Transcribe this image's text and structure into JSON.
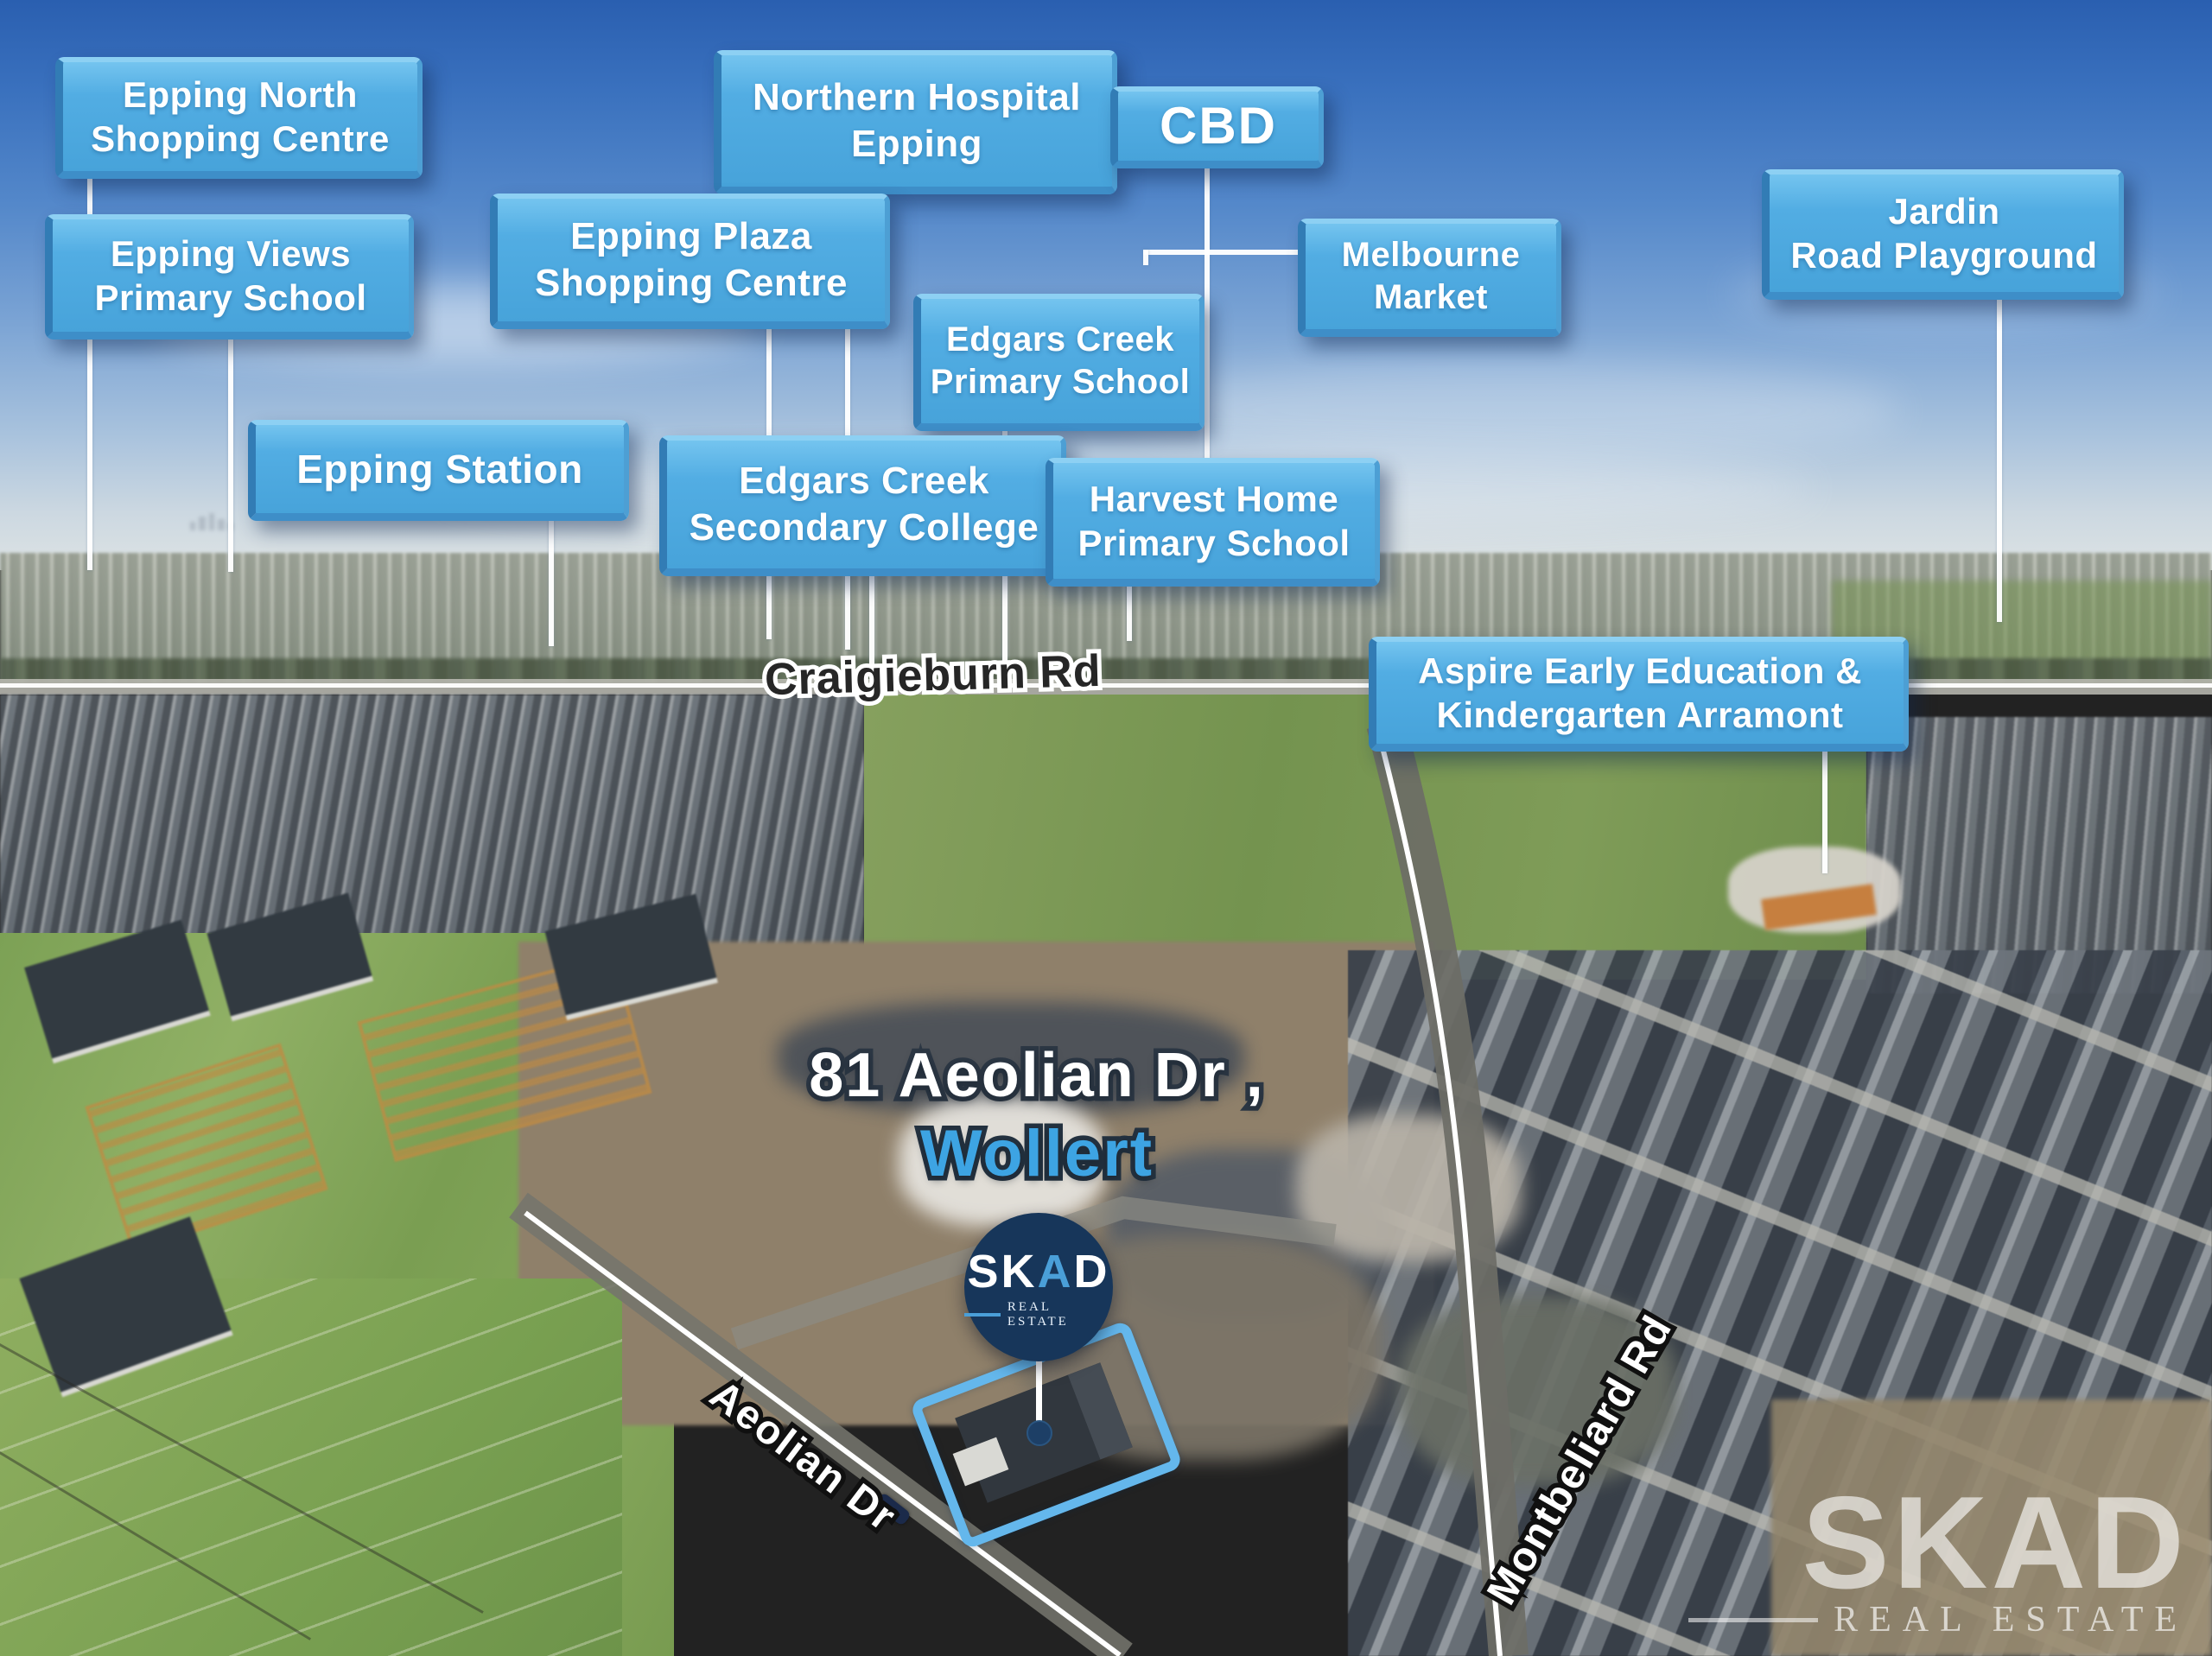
{
  "signs": {
    "epping_north": {
      "line1": "Epping North",
      "line2": "Shopping Centre"
    },
    "epping_views": {
      "line1": "Epping Views",
      "line2": "Primary School"
    },
    "northern_hospital": {
      "line1": "Northern Hospital",
      "line2": "Epping"
    },
    "epping_plaza": {
      "line1": "Epping Plaza",
      "line2": "Shopping Centre"
    },
    "cbd": {
      "line1": "CBD"
    },
    "melbourne_market": {
      "line1": "Melbourne",
      "line2": "Market"
    },
    "edgars_creek_primary": {
      "line1": "Edgars Creek",
      "line2": "Primary School"
    },
    "epping_station": {
      "line1": "Epping Station"
    },
    "edgars_creek_secondary": {
      "line1": "Edgars Creek",
      "line2": "Secondary College"
    },
    "harvest_home": {
      "line1": "Harvest Home",
      "line2": "Primary School"
    },
    "jardin": {
      "line1": "Jardin",
      "line2": "Road Playground"
    },
    "aspire": {
      "line1": "Aspire Early Education &",
      "line2": "Kindergarten Arramont"
    }
  },
  "roads": {
    "craigieburn": "Craigieburn Rd",
    "aeolian": "Aeolian Dr",
    "montbeliard": "Montbeliard Rd"
  },
  "property": {
    "address": "81 Aeolian Dr ,",
    "suburb": "Wollert"
  },
  "logo": {
    "brand_s": "S",
    "brand_k": "K",
    "brand_a": "A",
    "brand_d": "D",
    "tagline": "REAL ESTATE"
  },
  "watermark": {
    "brand": "SKAD",
    "tagline": "REAL ESTATE"
  },
  "colors": {
    "sign_blue": "#52ade3",
    "sign_text": "#ffffff",
    "suburb_text_blue": "#3da4e3",
    "logo_navy": "#17365a",
    "highlight_outline_blue": "#64b7ec"
  }
}
